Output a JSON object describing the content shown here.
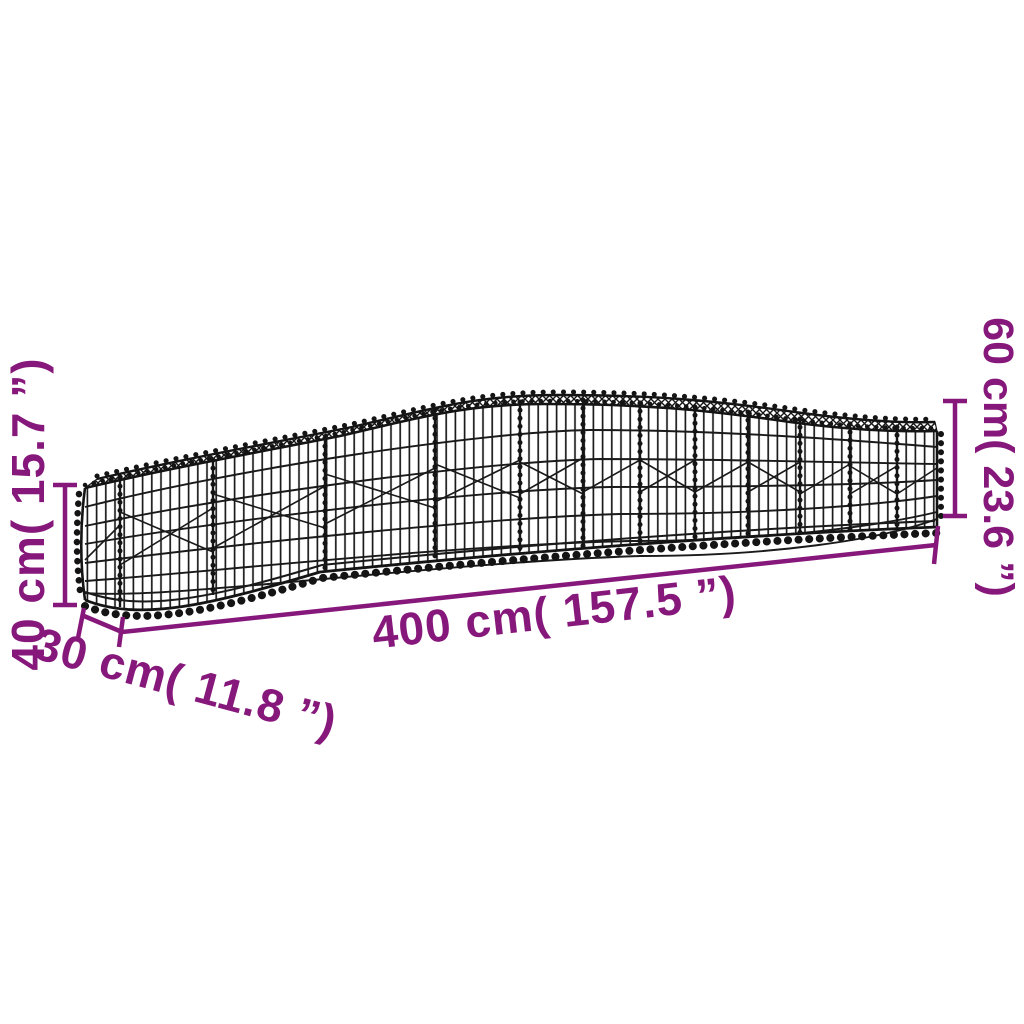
{
  "image": {
    "type": "product dimension diagram",
    "subject": "arched gabion wire-mesh basket",
    "background_color": "#ffffff",
    "wire_color": "#1a1a1a",
    "dimension_color": "#87187b",
    "dimensions": {
      "length_label": "400 cm( 157.5 ”)",
      "depth_label": "30 cm( 11.8 ”)",
      "left_height_label": "40 cm( 15.7 ”)",
      "right_height_label": "60 cm( 23.6 ”)"
    }
  }
}
